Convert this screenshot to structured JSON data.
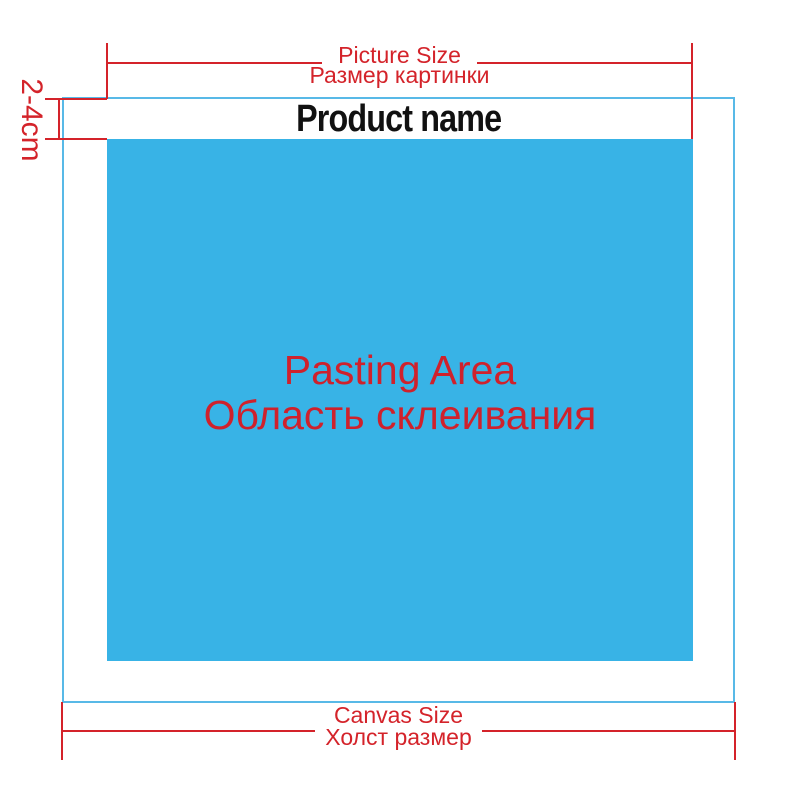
{
  "diagram": {
    "top_dimension": {
      "label_en": "Picture Size",
      "label_ru": "Размер картинки"
    },
    "margin_label": "2-4cm",
    "product_name": "Product name",
    "pasting_area": {
      "label_en": "Pasting Area",
      "label_ru": "Область склеивания"
    },
    "bottom_dimension": {
      "label_en": "Canvas Size",
      "label_ru": "Холст размер"
    },
    "colors": {
      "dimension_red": "#d4232a",
      "pasting_area_blue": "#38b3e6",
      "canvas_outline_blue": "#58b9e7",
      "product_name_black": "#111111",
      "background_white": "#ffffff"
    }
  }
}
